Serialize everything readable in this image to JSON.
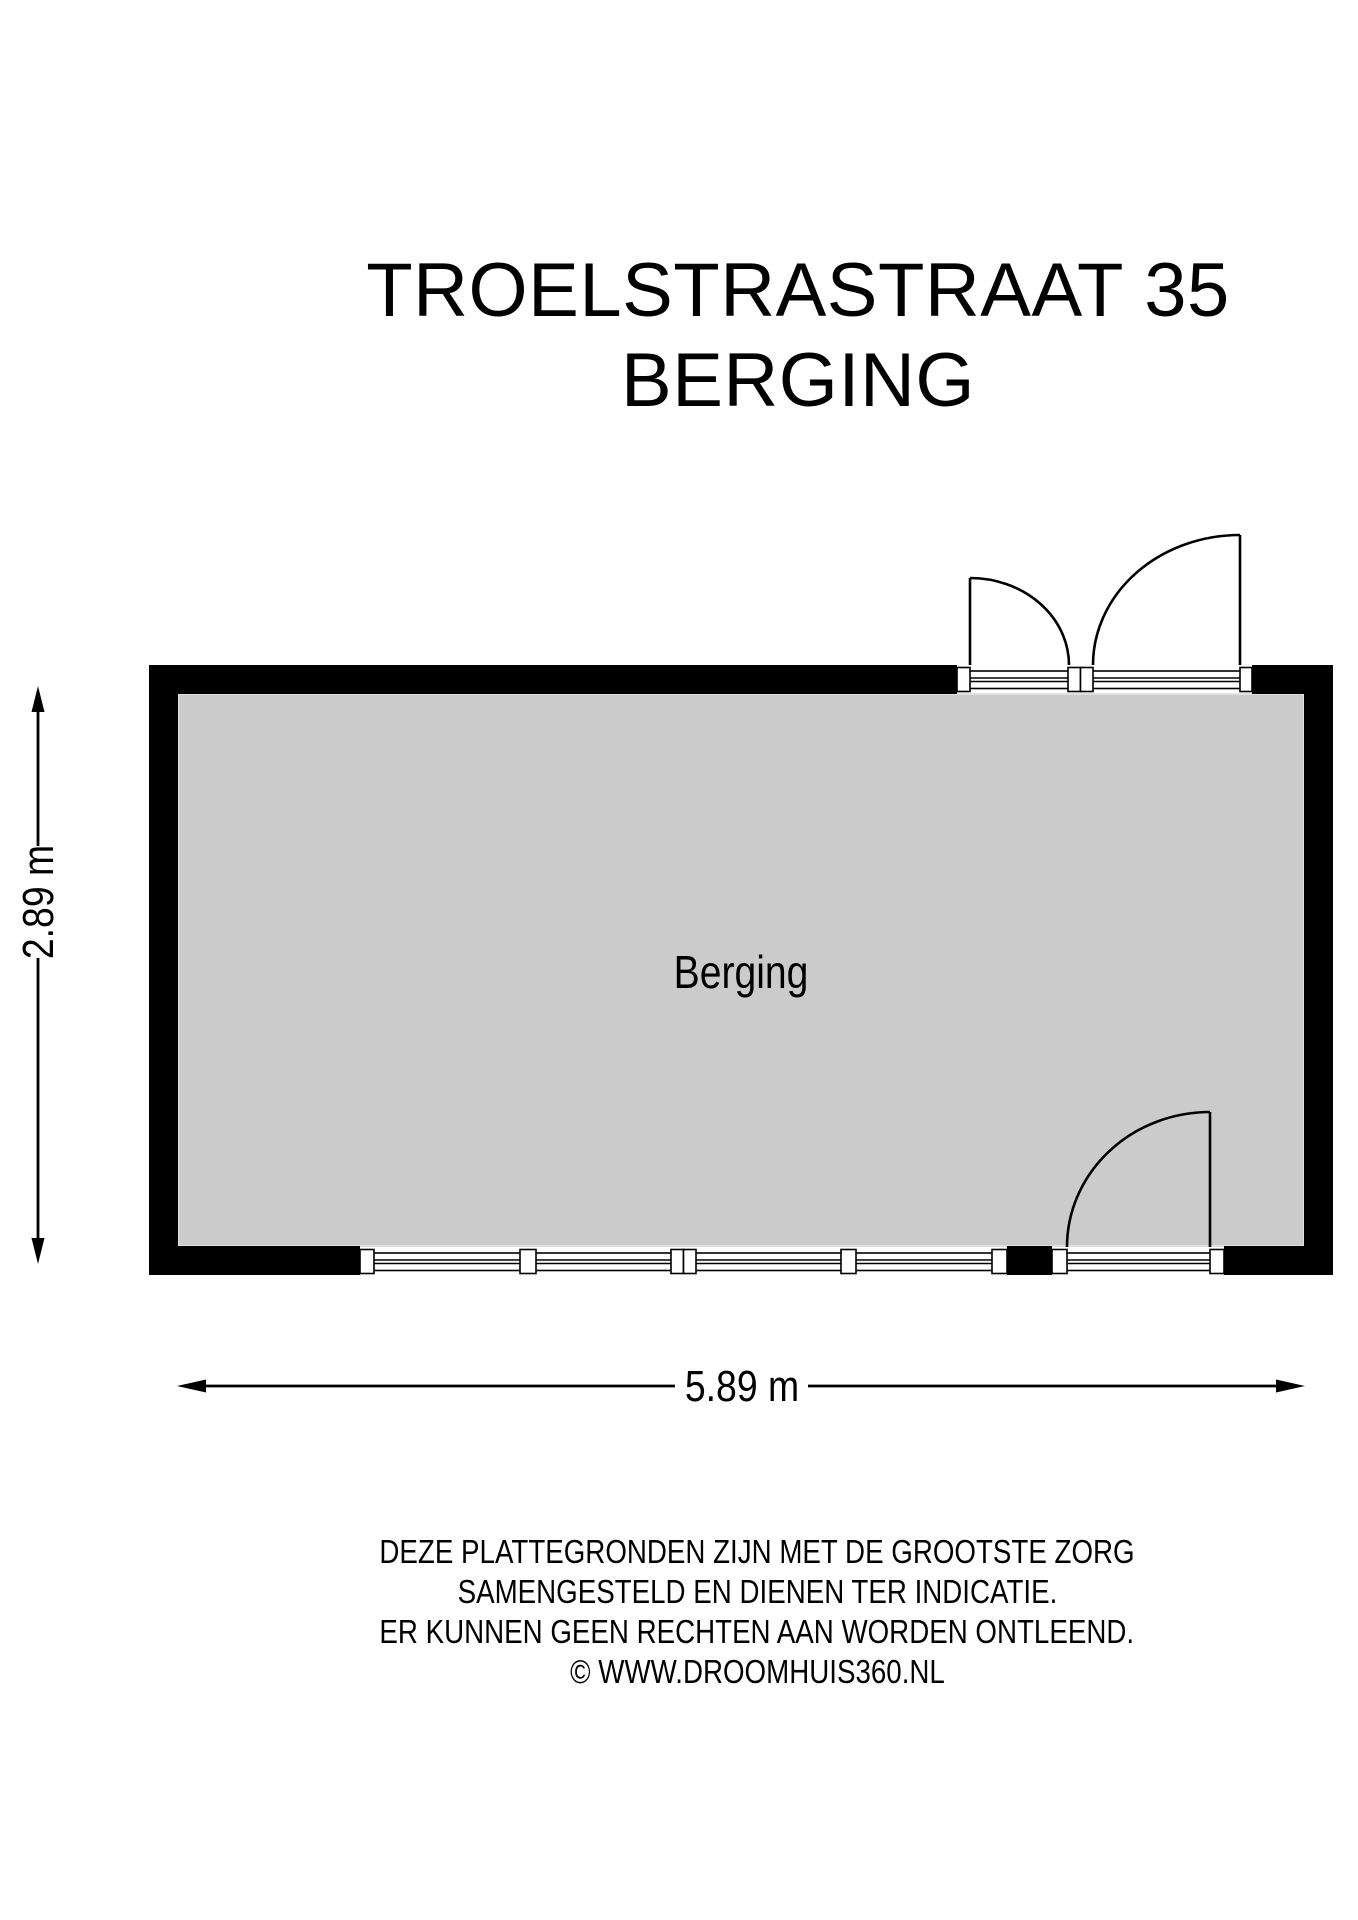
{
  "title": {
    "line1": "TROELSTRASTRAAT 35",
    "line2": "BERGING"
  },
  "floor_plan": {
    "room_label": "Berging",
    "dimensions": {
      "height_label": "2.89 m",
      "width_label": "5.89 m"
    }
  },
  "disclaimer": {
    "line1": "DEZE PLATTEGRONDEN ZIJN MET DE GROOTSTE ZORG",
    "line2": "SAMENGESTELD EN DIENEN TER INDICATIE.",
    "line3": "ER KUNNEN GEEN RECHTEN AAN WORDEN ONTLEEND.",
    "line4": "© WWW.DROOMHUIS360.NL"
  },
  "colors": {
    "wall": "#000000",
    "room_fill": "#cbcbcb",
    "room_edge": "#e0e0e0",
    "background": "#ffffff",
    "ink": "#000000"
  }
}
